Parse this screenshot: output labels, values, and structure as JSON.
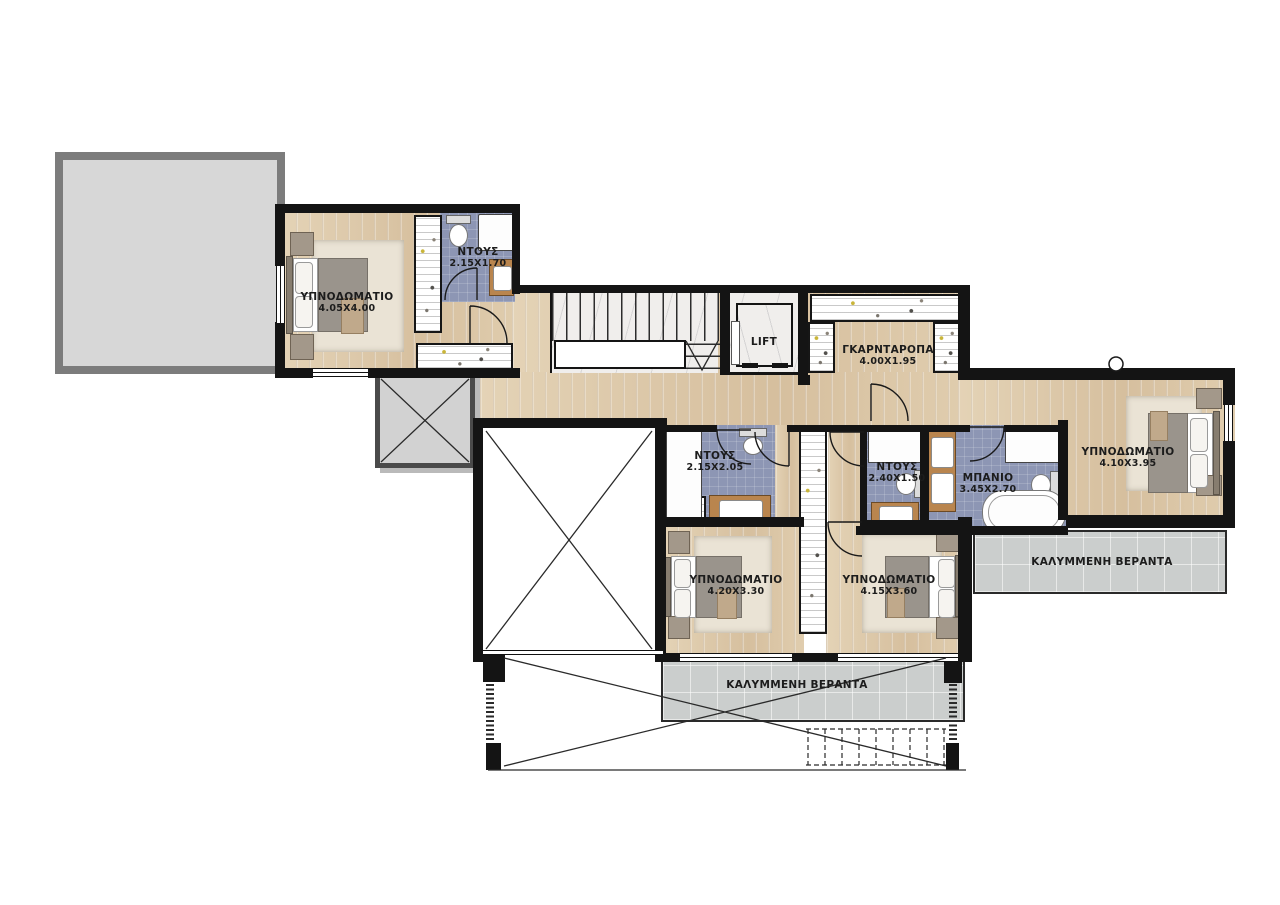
{
  "plan": {
    "type": "architectural-floor-plan",
    "floor": "upper-floor",
    "palette": {
      "wall": "#141414",
      "wood_floor": "#dcc7a9",
      "bath_tile": "#8d96b4",
      "veranda_tile": "#cbcecd",
      "roof_terrace": "#d7d7d7",
      "marble": "#f0eeec",
      "label_text": "#1c1c1c"
    },
    "rooms": [
      {
        "id": "bedroom-1",
        "name": "ΥΠΝΟΔΩΜΑΤΙΟ",
        "dims": "4.05X4.00"
      },
      {
        "id": "shower-1",
        "name": "ΝΤΟΥΣ",
        "dims": "2.15X1.70"
      },
      {
        "id": "lift",
        "name": "LIFT",
        "dims": ""
      },
      {
        "id": "wardrobe",
        "name": "ΓΚΑΡΝΤΑΡΟΠΑ",
        "dims": "4.00X1.95"
      },
      {
        "id": "shower-2",
        "name": "ΝΤΟΥΣ",
        "dims": "2.15X2.05"
      },
      {
        "id": "shower-3",
        "name": "ΝΤΟΥΣ",
        "dims": "2.40X1.50"
      },
      {
        "id": "bathroom",
        "name": "ΜΠΑΝΙΟ",
        "dims": "3.45X2.70"
      },
      {
        "id": "bedroom-2",
        "name": "ΥΠΝΟΔΩΜΑΤΙΟ",
        "dims": "4.10X3.95"
      },
      {
        "id": "veranda-right",
        "name": "ΚΑΛΥΜΜΕΝΗ ΒΕΡΑΝΤΑ",
        "dims": ""
      },
      {
        "id": "bedroom-3",
        "name": "ΥΠΝΟΔΩΜΑΤΙΟ",
        "dims": "4.20X3.30"
      },
      {
        "id": "bedroom-4",
        "name": "ΥΠΝΟΔΩΜΑΤΙΟ",
        "dims": "4.15X3.60"
      },
      {
        "id": "veranda-bottom",
        "name": "ΚΑΛΥΜΜΕΝΗ ΒΕΡΑΝΤΑ",
        "dims": ""
      }
    ]
  }
}
